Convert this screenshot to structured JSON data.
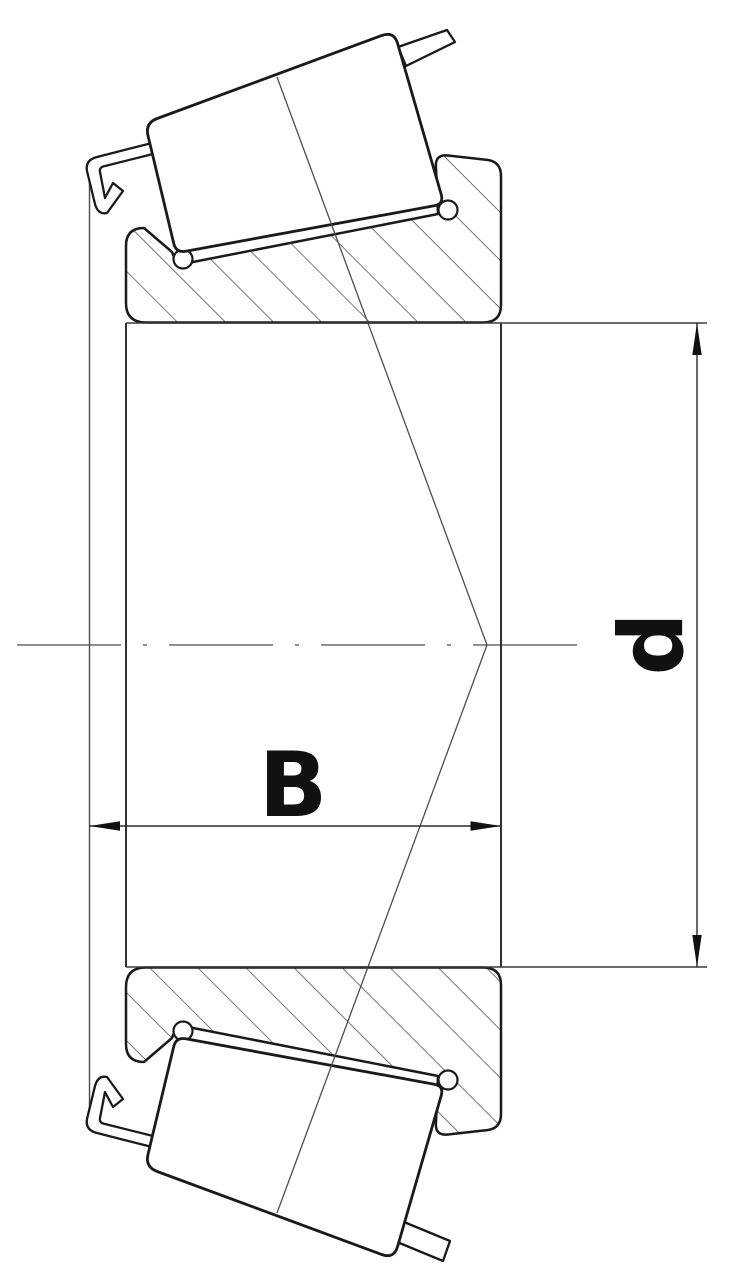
{
  "drawing": {
    "type": "engineering-section-drawing",
    "subject": "tapered roller bearing cone: inner ring with tapered rollers and cage, cross-section",
    "labels": {
      "width": "B",
      "bore_diameter": "d"
    },
    "colors": {
      "outline": "#1a1a1a",
      "thin_line": "#4d4d4d",
      "dimension_line": "#2a2a2a",
      "arrow_fill": "#111111",
      "background": "#ffffff"
    }
  }
}
